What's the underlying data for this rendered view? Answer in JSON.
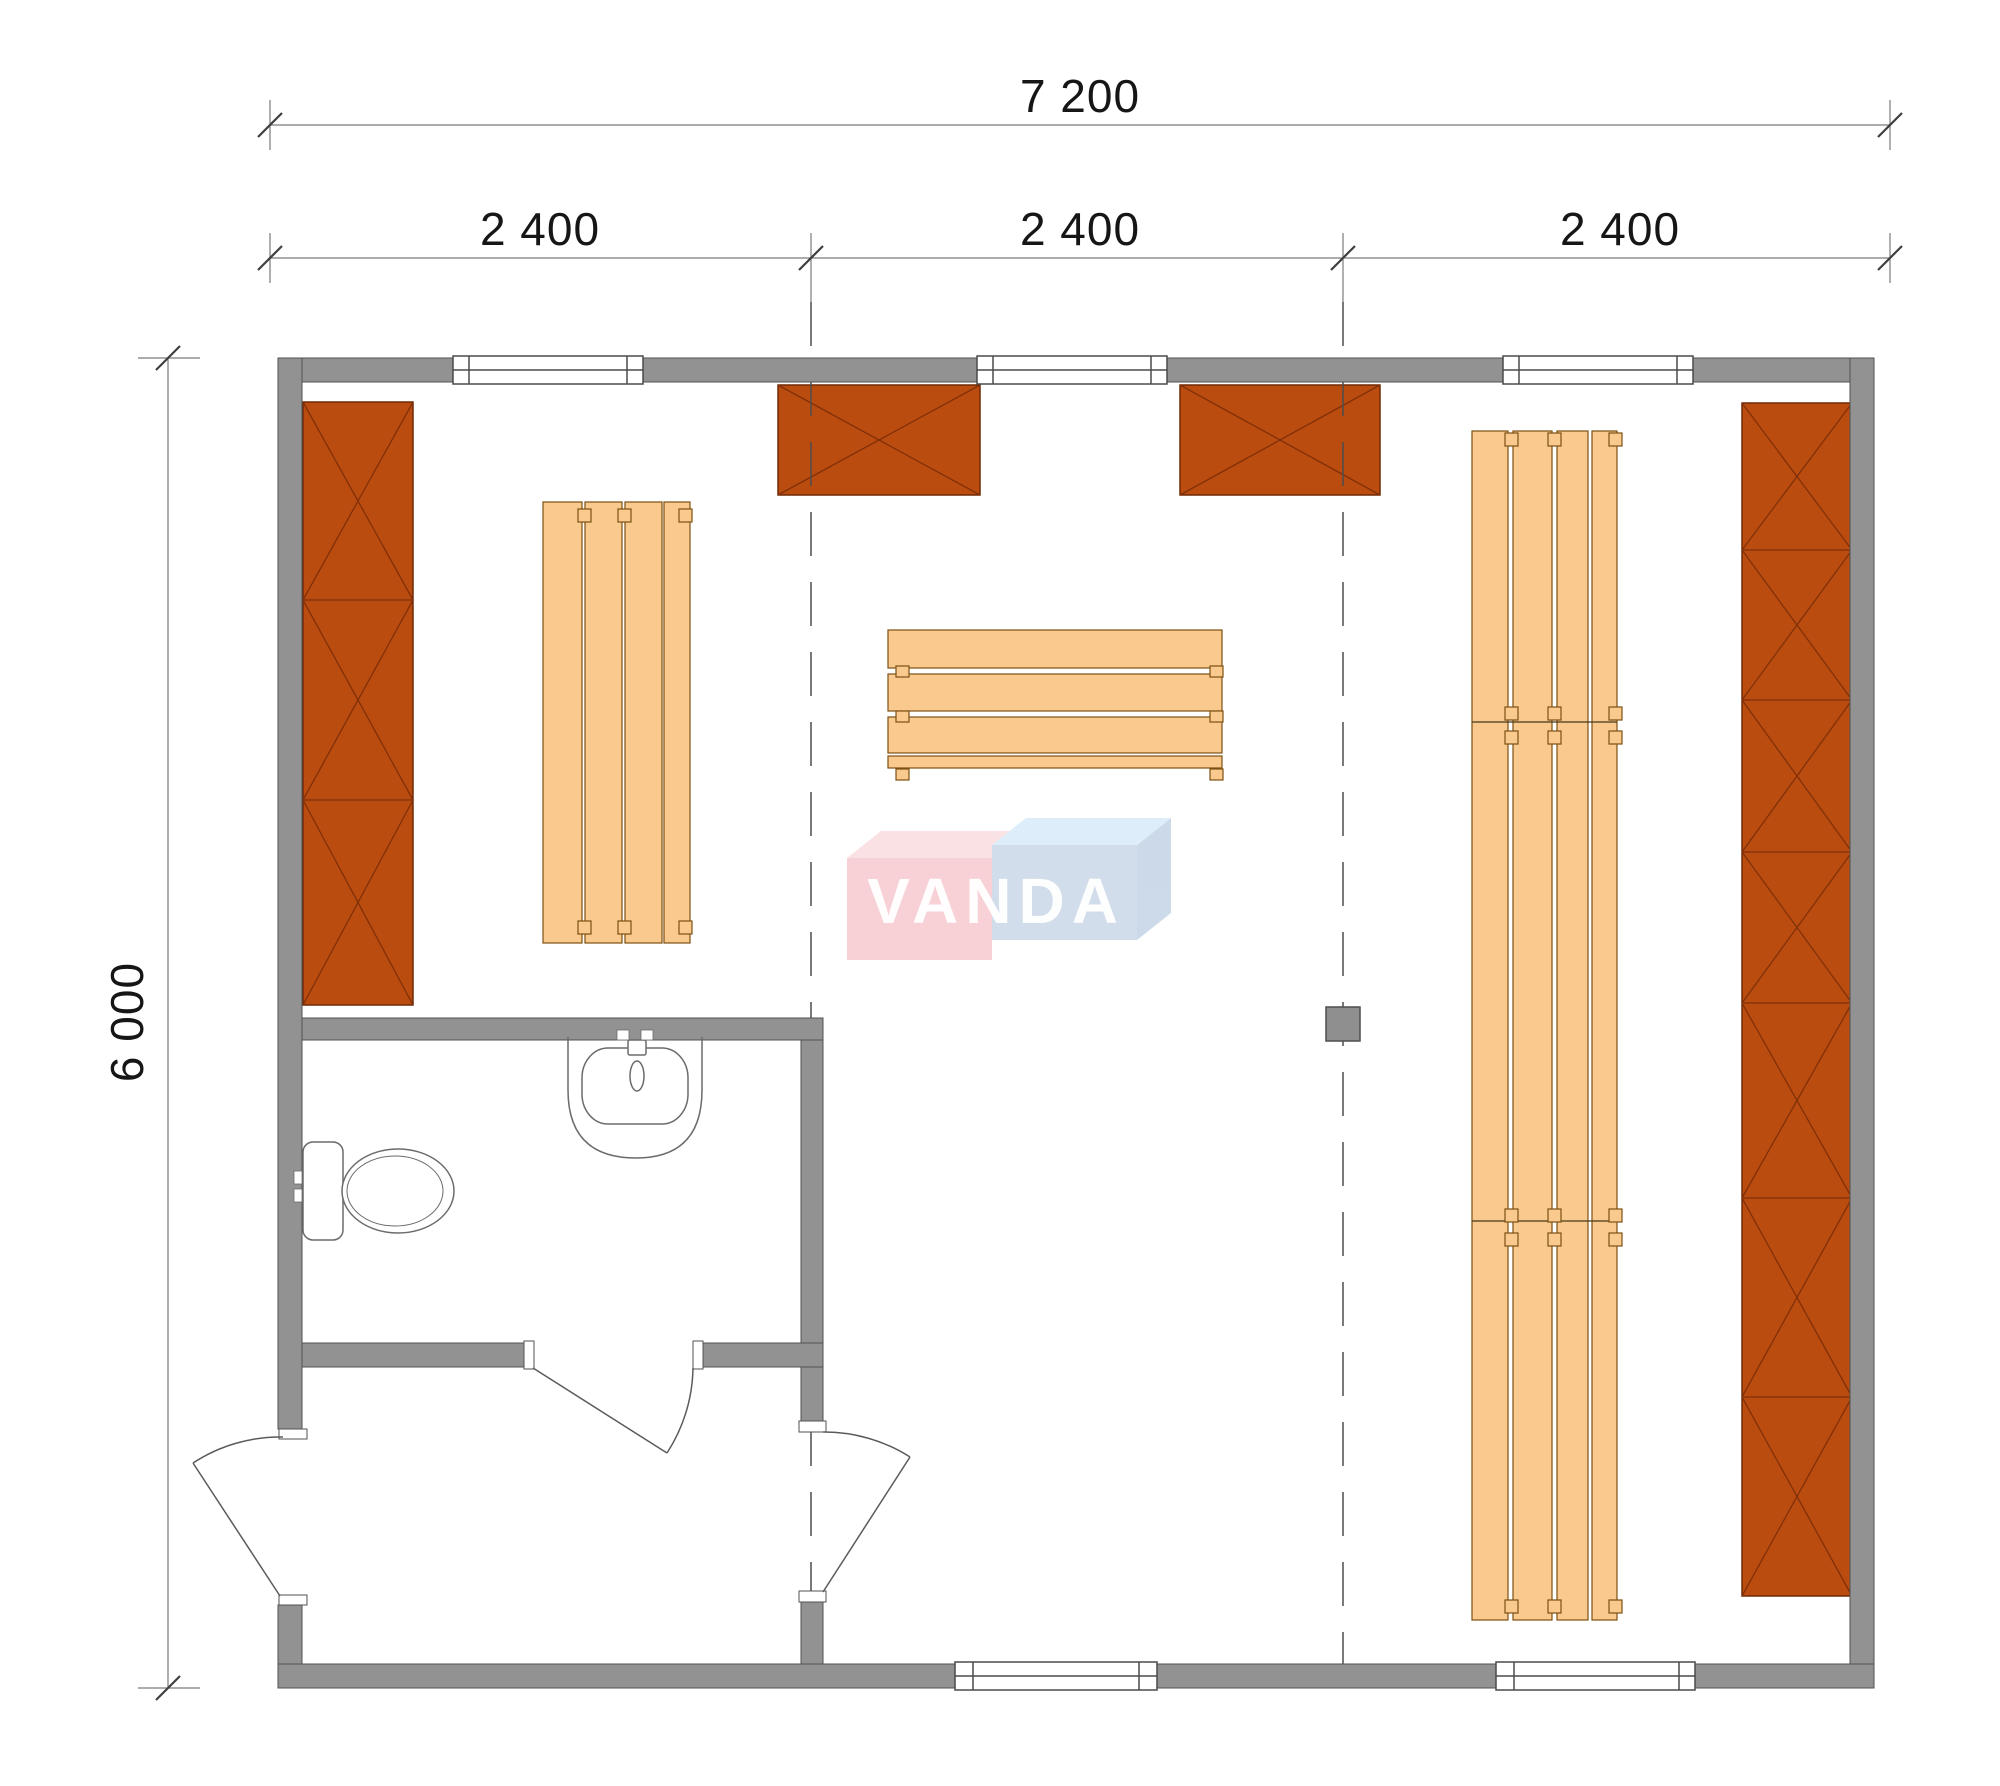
{
  "dimensions": {
    "total_width_label": "7 200",
    "bays": [
      {
        "label": "2 400"
      },
      {
        "label": "2 400"
      },
      {
        "label": "2 400"
      }
    ],
    "height_label": "6 000"
  },
  "watermark": {
    "text": "VANDA"
  },
  "colors": {
    "wall_gray": "#929292",
    "wall_outline": "#525252",
    "cabinet_orange": "#bb4c10",
    "cabinet_outline": "#6f2a06",
    "cabinet_cross": "#803008",
    "bench_tan": "#f9c98e",
    "bench_outline": "#7d5012",
    "fixture_stroke": "#6b6b6b",
    "dashed_partition": "#4d4d4d",
    "dimension_line": "#7a7a7a",
    "dimension_tick": "#3f3f3f",
    "logo_pink_front": "#f6c9ce",
    "logo_pink_top": "#fadde0",
    "logo_blue_front": "#cbd8e8",
    "logo_blue_top": "#d8ecfa",
    "logo_blue_side": "#c3d3e5"
  },
  "plan_elements": [
    {
      "name": "left-wardrobe-cabinet",
      "type": "crossed-cabinet",
      "sections": 3
    },
    {
      "name": "right-wardrobe-cabinet",
      "type": "crossed-cabinet",
      "sections": 7
    },
    {
      "name": "wall-cabinet-1",
      "type": "crossed-cabinet",
      "sections": 1
    },
    {
      "name": "wall-cabinet-2",
      "type": "crossed-cabinet",
      "sections": 1
    },
    {
      "name": "left-bench",
      "type": "slatted-bench",
      "slats": 4
    },
    {
      "name": "center-bench",
      "type": "slatted-bench",
      "slats": 4
    },
    {
      "name": "right-bench",
      "type": "slatted-bench",
      "slats": 4,
      "segments": 3
    },
    {
      "name": "toilet",
      "type": "sanitary-fixture"
    },
    {
      "name": "washbasin",
      "type": "sanitary-fixture"
    },
    {
      "name": "top-windows",
      "count": 3
    },
    {
      "name": "bottom-windows",
      "count": 2
    },
    {
      "name": "doors",
      "count": 3
    },
    {
      "name": "heater-block",
      "type": "equipment"
    }
  ]
}
